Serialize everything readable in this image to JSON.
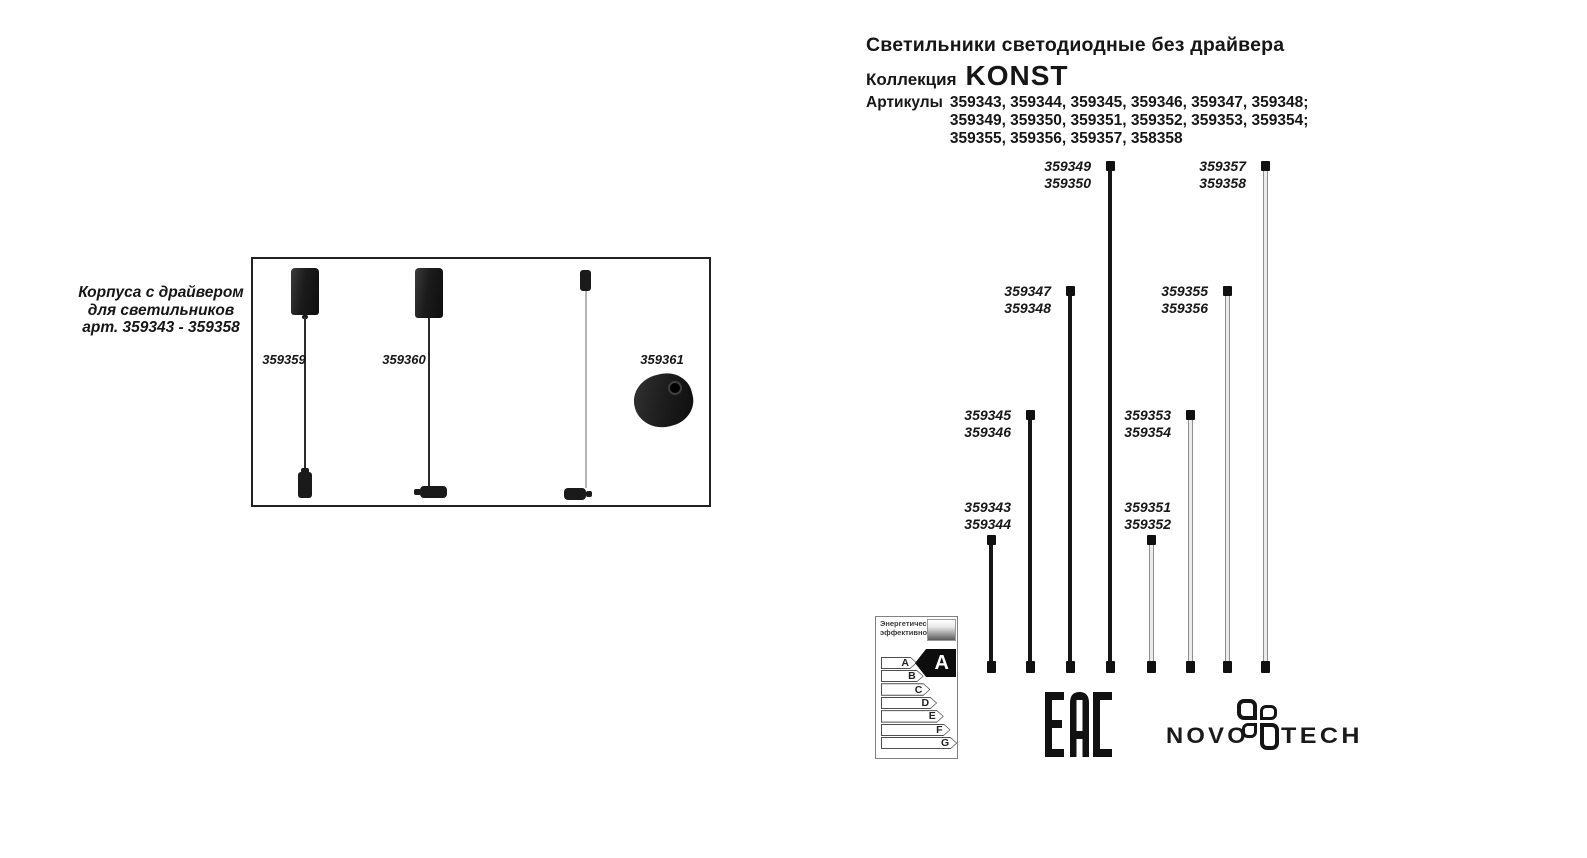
{
  "header": {
    "title": "Светильники светодиодные без драйвера",
    "collection_label": "Коллекция",
    "collection_name": "KONST",
    "articles_label": "Артикулы",
    "articles_lines": [
      "359343, 359344, 359345, 359346, 359347, 359348;",
      "359349, 359350, 359351, 359352, 359353, 359354;",
      "359355, 359356, 359357, 358358"
    ]
  },
  "left_panel": {
    "caption_lines": [
      "Корпуса с драйвером",
      "для светильников",
      "арт. 359343 - 359358"
    ],
    "items": [
      {
        "article": "359359"
      },
      {
        "article": "359360"
      },
      {
        "article": "359361"
      }
    ]
  },
  "diagram": {
    "rods": [
      {
        "articles": [
          "359343",
          "359344"
        ],
        "finish": "black",
        "length_level": 1
      },
      {
        "articles": [
          "359345",
          "359346"
        ],
        "finish": "black",
        "length_level": 2
      },
      {
        "articles": [
          "359347",
          "359348"
        ],
        "finish": "black",
        "length_level": 3
      },
      {
        "articles": [
          "359349",
          "359350"
        ],
        "finish": "black",
        "length_level": 4
      },
      {
        "articles": [
          "359351",
          "359352"
        ],
        "finish": "white",
        "length_level": 1
      },
      {
        "articles": [
          "359353",
          "359354"
        ],
        "finish": "white",
        "length_level": 2
      },
      {
        "articles": [
          "359355",
          "359356"
        ],
        "finish": "white",
        "length_level": 3
      },
      {
        "articles": [
          "359357",
          "359358"
        ],
        "finish": "white",
        "length_level": 4
      }
    ]
  },
  "energy_label": {
    "title_lines": "Энергетическая\nэффективность",
    "classes": [
      "A",
      "B",
      "C",
      "D",
      "E",
      "F",
      "G"
    ],
    "rating": "A"
  },
  "certification": {
    "eac": "EAC"
  },
  "brand": {
    "left": "NOVO",
    "right": "TECH"
  },
  "colors": {
    "text": "#161616",
    "rod_black": "#161616",
    "rod_white": "#ebebeb"
  }
}
